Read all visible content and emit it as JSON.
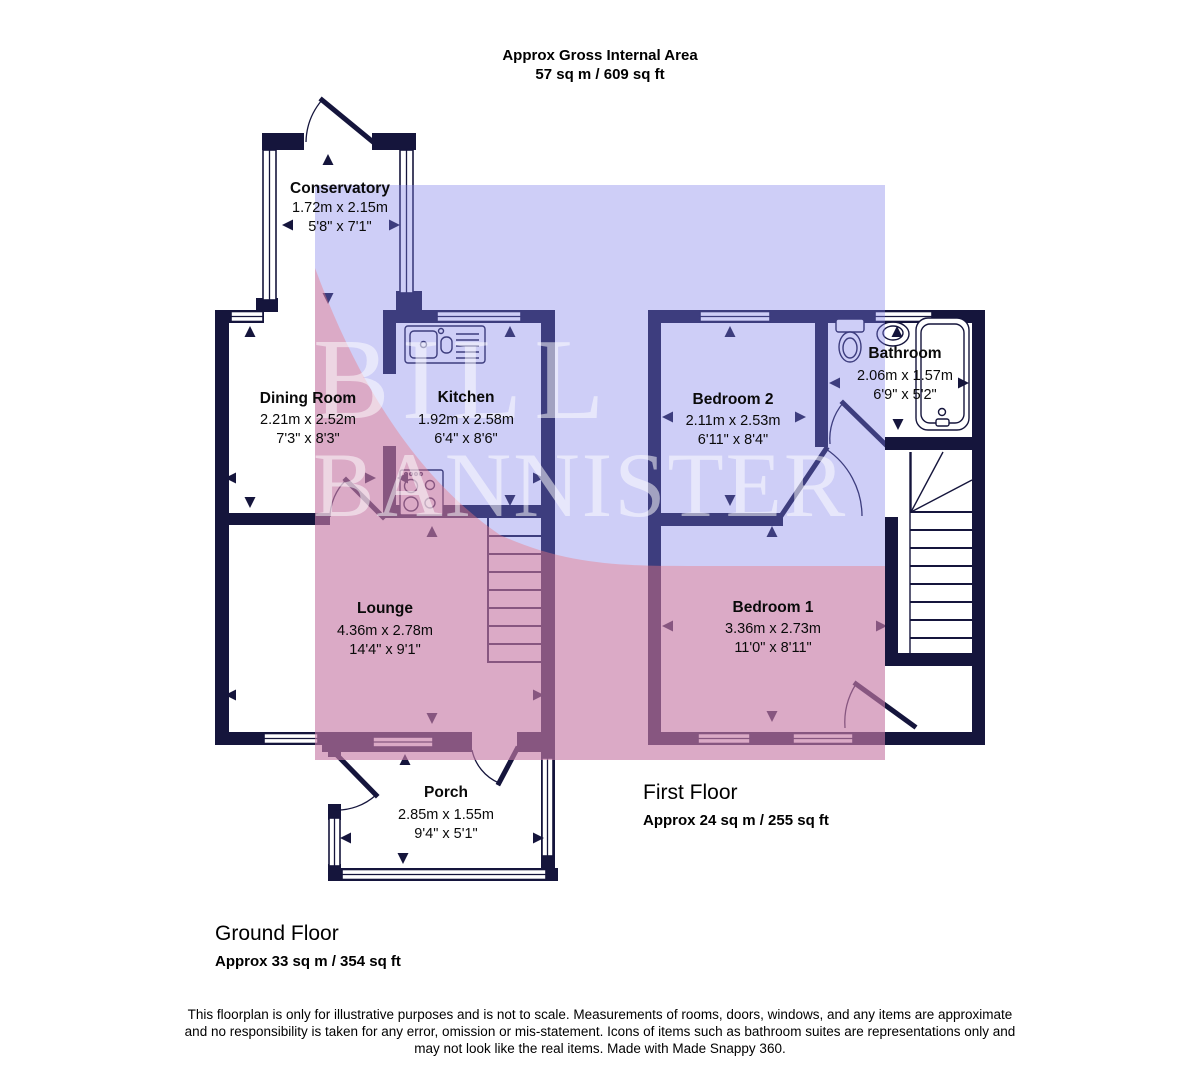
{
  "header": {
    "line1": "Approx Gross Internal Area",
    "line2": "57 sq m / 609 sq ft"
  },
  "watermark": {
    "line1": "BILL",
    "line2": "BANNISTER"
  },
  "ground_floor": {
    "title": "Ground Floor",
    "area": "Approx 33 sq m / 354 sq ft",
    "rooms": {
      "conservatory": {
        "name": "Conservatory",
        "metric": "1.72m x 2.15m",
        "imperial": "5'8\" x 7'1\""
      },
      "dining_room": {
        "name": "Dining Room",
        "metric": "2.21m x 2.52m",
        "imperial": "7'3\" x 8'3\""
      },
      "kitchen": {
        "name": "Kitchen",
        "metric": "1.92m x 2.58m",
        "imperial": "6'4\" x 8'6\""
      },
      "lounge": {
        "name": "Lounge",
        "metric": "4.36m x 2.78m",
        "imperial": "14'4\" x 9'1\""
      },
      "porch": {
        "name": "Porch",
        "metric": "2.85m x 1.55m",
        "imperial": "9'4\" x 5'1\""
      }
    }
  },
  "first_floor": {
    "title": "First Floor",
    "area": "Approx 24 sq m / 255 sq ft",
    "rooms": {
      "bedroom2": {
        "name": "Bedroom 2",
        "metric": "2.11m x 2.53m",
        "imperial": "6'11\" x 8'4\""
      },
      "bathroom": {
        "name": "Bathroom",
        "metric": "2.06m x 1.57m",
        "imperial": "6'9\" x 5'2\""
      },
      "bedroom1": {
        "name": "Bedroom 1",
        "metric": "3.36m x 2.73m",
        "imperial": "11'0\" x 8'11\""
      }
    }
  },
  "footer": {
    "line1": "This floorplan is only for illustrative purposes and is not to scale. Measurements of rooms, doors, windows, and any items are approximate",
    "line2": "and no responsibility is taken for any error, omission or mis-statement. Icons of items such as bathroom suites are representations only and",
    "line3": "may not look like the real items. Made with Made Snappy 360."
  },
  "colors": {
    "wall": "#15153c",
    "overlay_blue": "#7d7deb",
    "overlay_pink": "#ee7a84",
    "watermark_text": "#ffffff"
  }
}
